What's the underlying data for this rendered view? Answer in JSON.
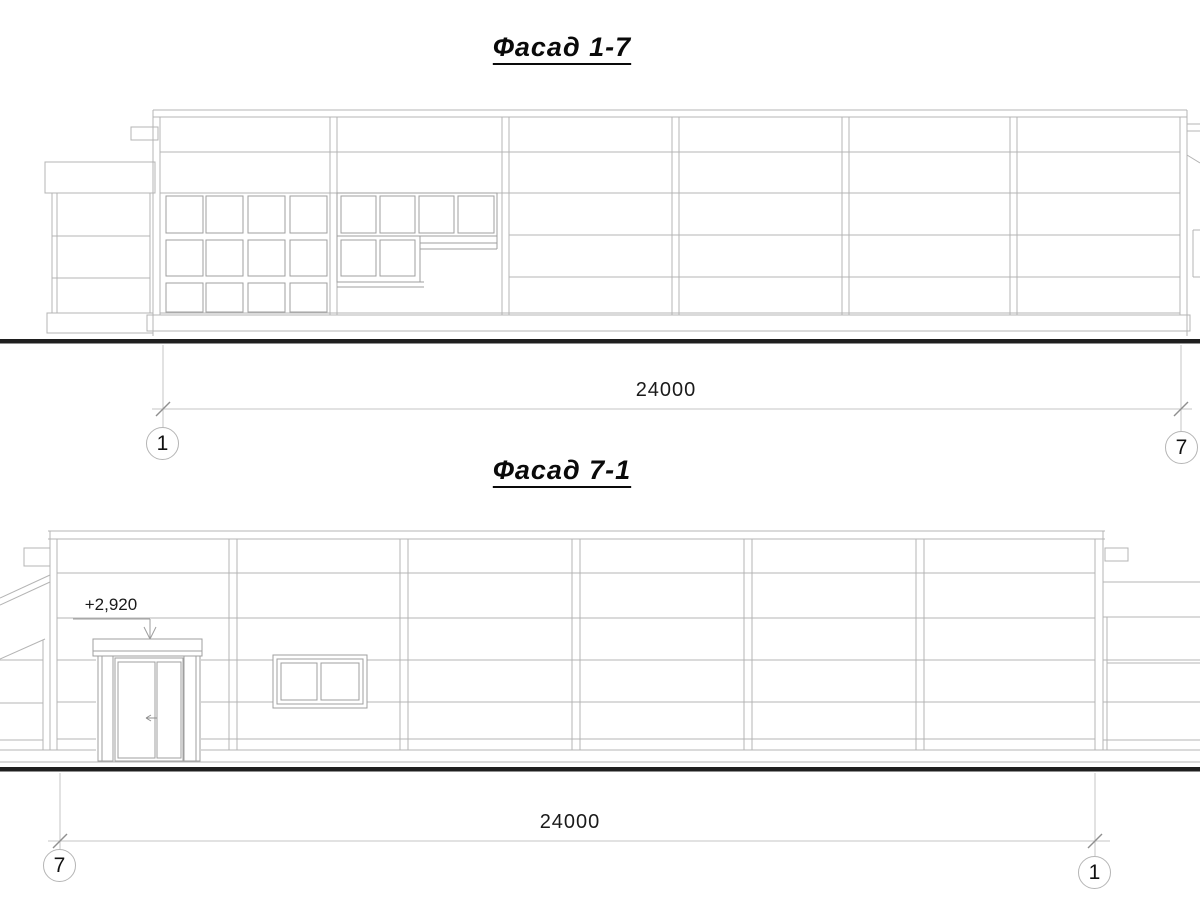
{
  "sheet": {
    "background": "#ffffff",
    "colors": {
      "wall_line": "#b4b4b4",
      "frame_line": "#9f9f9f",
      "dim_line": "#c6c6c6",
      "tick_line": "#8f8f8f",
      "ground_line": "#1f1f1f",
      "text": "#111111"
    }
  },
  "facade_top": {
    "title": "Фасад 1-7",
    "dimension_label": "24000",
    "axis_left_label": "1",
    "axis_right_label": "7"
  },
  "facade_bottom": {
    "title": "Фасад 7-1",
    "dimension_label": "24000",
    "axis_left_label": "7",
    "axis_right_label": "1",
    "elevation_label": "+2,920"
  }
}
